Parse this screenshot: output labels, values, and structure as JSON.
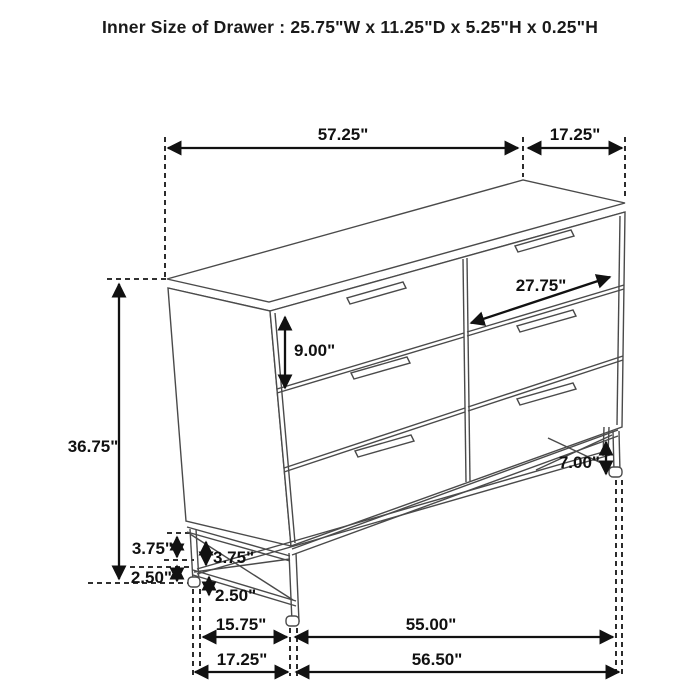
{
  "title": "Inner Size of Drawer : 25.75\"W x 11.25\"D x 5.25\"H x 0.25\"H",
  "diagram": {
    "subject": "six-drawer dresser dimension diagram",
    "dims": {
      "top_width": "57.25\"",
      "top_depth": "17.25\"",
      "drawer_width": "27.75\"",
      "drawer_height": "9.00\"",
      "overall_height": "36.75\"",
      "base_gap_outer": "3.75\"",
      "base_gap_inner": "3.75\"",
      "base_floor_outer": "2.50\"",
      "base_floor_inner": "2.50\"",
      "leg_height": "7.00\"",
      "bottom_inner_depth": "15.75\"",
      "bottom_inner_width": "55.00\"",
      "bottom_outer_depth": "17.25\"",
      "bottom_outer_width": "56.50\""
    }
  }
}
